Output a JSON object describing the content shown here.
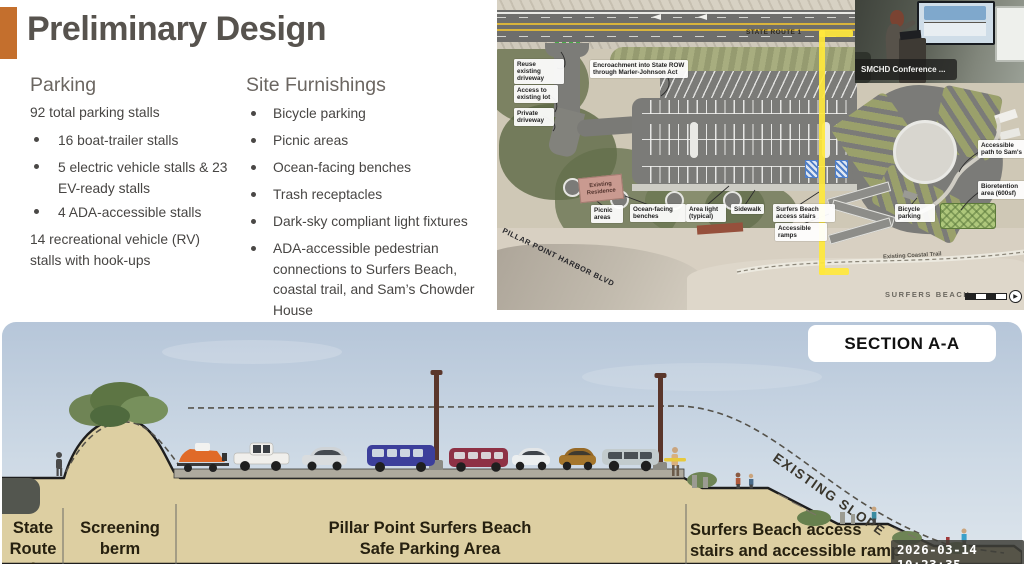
{
  "theme": {
    "accent": "#c46f2d",
    "highlight": "#ffe83c"
  },
  "slide": {
    "title": "Preliminary Design",
    "parking": {
      "heading": "Parking",
      "intro": "92 total parking stalls",
      "bullets": [
        "16 boat-trailer stalls",
        "5 electric vehicle stalls & 23 EV-ready stalls",
        "4 ADA-accessible stalls"
      ],
      "outro": "14 recreational vehicle (RV) stalls with hook-ups"
    },
    "furnishings": {
      "heading": "Site Furnishings",
      "bullets": [
        "Bicycle parking",
        "Picnic areas",
        "Ocean-facing benches",
        "Trash receptacles",
        "Dark-sky compliant light fixtures",
        "ADA-accessible pedestrian connections to Surfers Beach, coastal trail, and Sam’s Chowder House"
      ]
    }
  },
  "site_plan": {
    "route_label": "STATE ROUTE 1",
    "street_label": "PILLAR POINT HARBOR BLVD",
    "beach_label": "SURFERS BEACH",
    "coastal_trail_label": "Existing Coastal Trail",
    "labels": {
      "reuse_driveway": "Reuse existing driveway",
      "access_lot": "Access to existing lot",
      "private_driveway": "Private driveway",
      "encroachment": "Encroachment into State ROW through Marler-Johnson Act",
      "existing_residence": "Existing Residence",
      "picnic_areas": "Picnic areas",
      "ocean_benches": "Ocean-facing benches",
      "area_light": "Area light (typical)",
      "sidewalk": "Sidewalk",
      "beach_stairs": "Surfers Beach access stairs",
      "accessible_ramps": "Accessible ramps",
      "bicycle_parking": "Bicycle parking",
      "path_to_sams": "Accessible path to Sam's",
      "bioretention": "Bioretention area (600sf)"
    }
  },
  "webcam": {
    "caption": "SMCHD Conference ..."
  },
  "section": {
    "badge": "SECTION A-A",
    "slope_label": "EXISTING SLOPE",
    "zones": [
      {
        "line1": "State",
        "line2": "Route 1"
      },
      {
        "line1": "Screening",
        "line2": "berm"
      },
      {
        "line1": "Pillar Point Surfers Beach",
        "line2": "Safe Parking Area"
      },
      {
        "line1": "Surfers Beach access",
        "line2": "stairs and accessible ramp"
      }
    ],
    "timestamp": "2026-03-14 10:23:35"
  }
}
